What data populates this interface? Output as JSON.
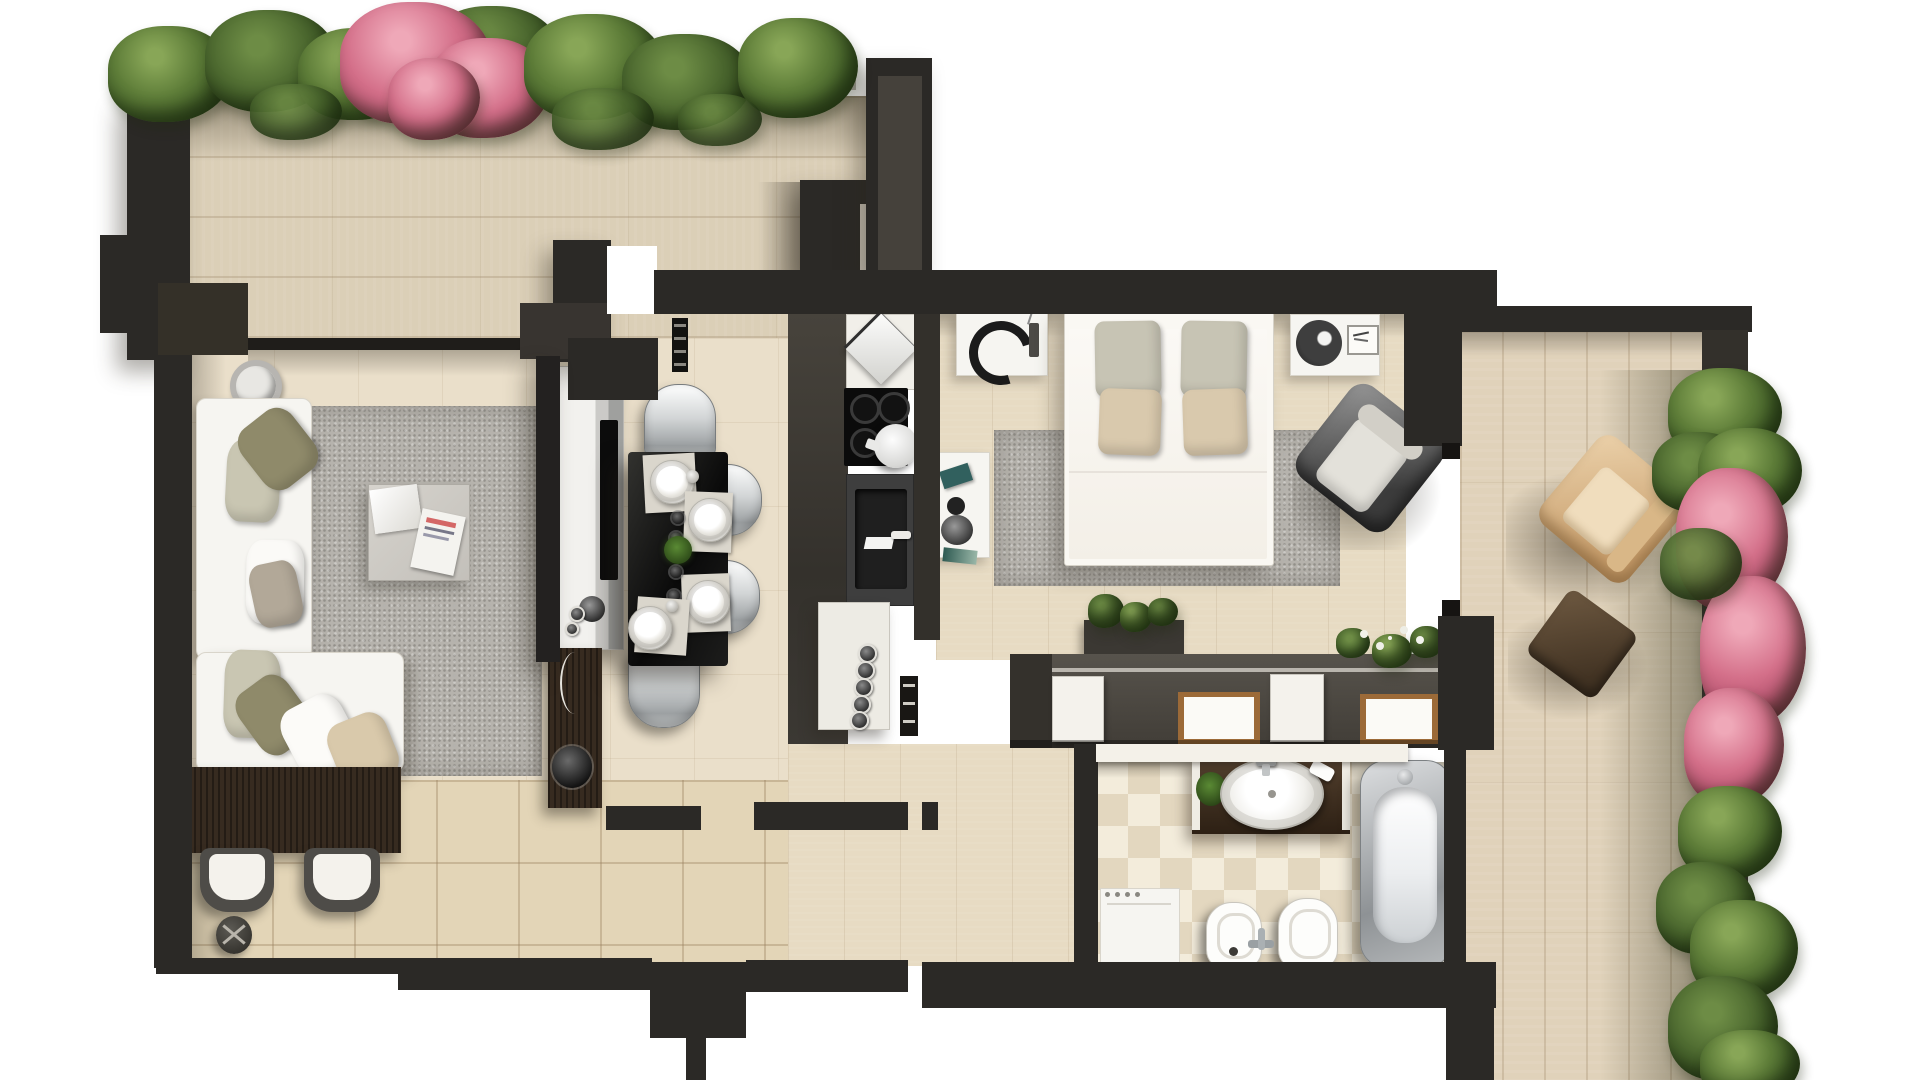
{
  "meta": {
    "title": "Apartment floor plan - photorealistic top-down 3D render",
    "visible_text": "none",
    "view": "overhead orthographic"
  },
  "palette": {
    "wall_dark": "#2b2926",
    "wall_light_face": "#45413b",
    "terrace_tile": "#dbcfb7",
    "living_floor": "#eadfca",
    "hall_tile": "#e3d5b7",
    "bedroom_plank": "#e7dbc3",
    "kitchen_walkway": "#3a3732",
    "bath_tile_light": "#f3ecdb",
    "bath_tile_dark": "#e3d7bf",
    "rug_gray": "#b6b3ad",
    "sofa_white": "#f6f5f1",
    "dining_table_black": "#141414",
    "desk_wood_brown": "#372b20",
    "vanity_wood_brown": "#4a3527",
    "wardrobe_wood_trim": "#9c6a38",
    "plant_green": "#5d7c38",
    "plant_pink": "#d4708a",
    "outdoor_chair_tan": "#d9b98f",
    "ottoman_brown": "#5f4b37"
  },
  "rooms": {
    "terrace_top": {
      "label": "Upper terrace",
      "furniture": [
        "tile floor",
        "hedge planter",
        "pink flowering shrub",
        "storage closet"
      ]
    },
    "living_room": {
      "label": "Living room",
      "furniture": [
        "corner sofa",
        "throw pillows",
        "gray rug",
        "coffee table",
        "magazine",
        "decor bowl",
        "console desk",
        "two guest chairs",
        "wastebasket",
        "tv sideboard",
        "flat tv",
        "speaker shelf",
        "subwoofer"
      ]
    },
    "dining_area": {
      "label": "Dining area",
      "furniture": [
        "black dining table",
        "four silver chairs",
        "four place settings",
        "green centerpiece"
      ]
    },
    "kitchen": {
      "label": "Kitchen",
      "furniture": [
        "decor dish",
        "four-burner cooktop",
        "kettle",
        "sink unit",
        "faucet",
        "base cabinet with knobs",
        "wall shelf"
      ]
    },
    "bedroom": {
      "label": "Bedroom",
      "furniture": [
        "double bed",
        "four pillows",
        "left nightstand with arc lamp",
        "right nightstand with lamp and frame",
        "gray rug",
        "lounge armchair",
        "vanity desk with accessories",
        "wardrobe row",
        "potted plants"
      ]
    },
    "bathroom": {
      "label": "Bathroom",
      "furniture": [
        "wood vanity counter",
        "oval sink",
        "faucet",
        "plant",
        "washing machine",
        "bidet",
        "toilet",
        "floor-mounted tap",
        "bathtub"
      ]
    },
    "hallway": {
      "label": "Entrance hall",
      "furniture": [
        "ceramic tile floor"
      ]
    },
    "terrace_right": {
      "label": "Side terrace",
      "furniture": [
        "plank floor",
        "outdoor armchair",
        "ottoman",
        "hedge",
        "pink flowering shrub"
      ]
    }
  }
}
